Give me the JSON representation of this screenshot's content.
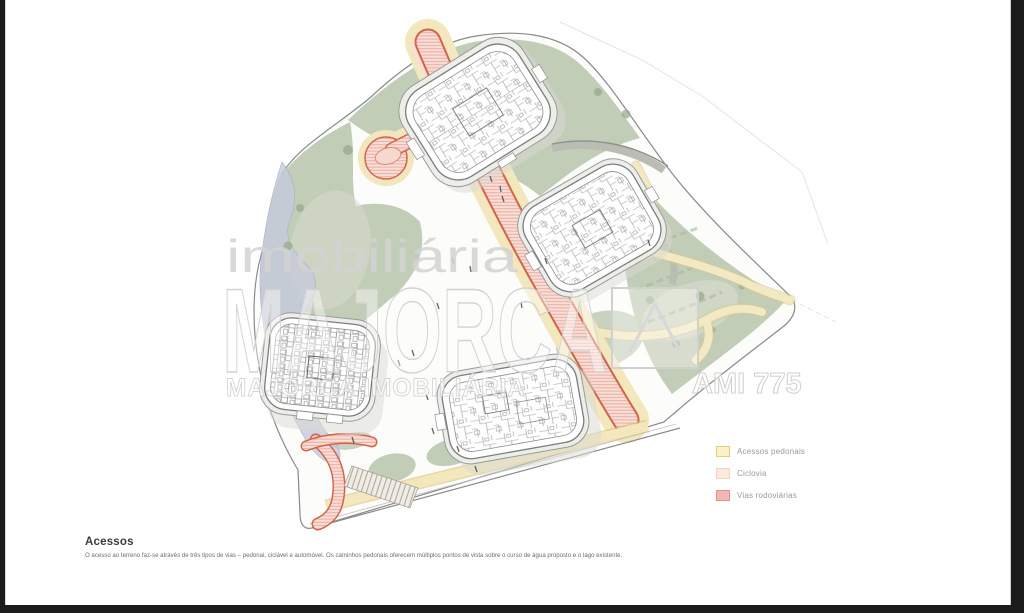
{
  "drawing": {
    "title": "Acessos",
    "description": "O acesso ao terreno faz-se através de três tipos de vias – pedonal, ciclável e automóvel. Os caminhos pedonais oferecem múltiplos pontos de vista sobre o curso de água proposto e o lago existente.",
    "legend": {
      "items": [
        {
          "label": "Acessos pedonais",
          "swatch": "#fbf2ca",
          "swatch_border": "#e4cd7c"
        },
        {
          "label": "Ciclovia",
          "swatch": "#fdeade",
          "swatch_border": "#f3d2c0"
        },
        {
          "label": "Vias rodoviárias",
          "swatch": "#f1b7b5",
          "swatch_border": "#e88e8b"
        }
      ]
    },
    "watermark": {
      "brand_top": "imobiliária",
      "brand_main": "MAJORCA",
      "tagline": "MAJORCA IMOBILIÁRIA",
      "license": "AMI 775"
    },
    "map_colors": {
      "pedestrian_path": "#f2e7bd",
      "cycleway": "#f9e0d0",
      "road_fill": "#f8ded6",
      "road_edge": "#d2644a",
      "green": "#c2cdb7",
      "water": "#c6cbdd"
    }
  }
}
